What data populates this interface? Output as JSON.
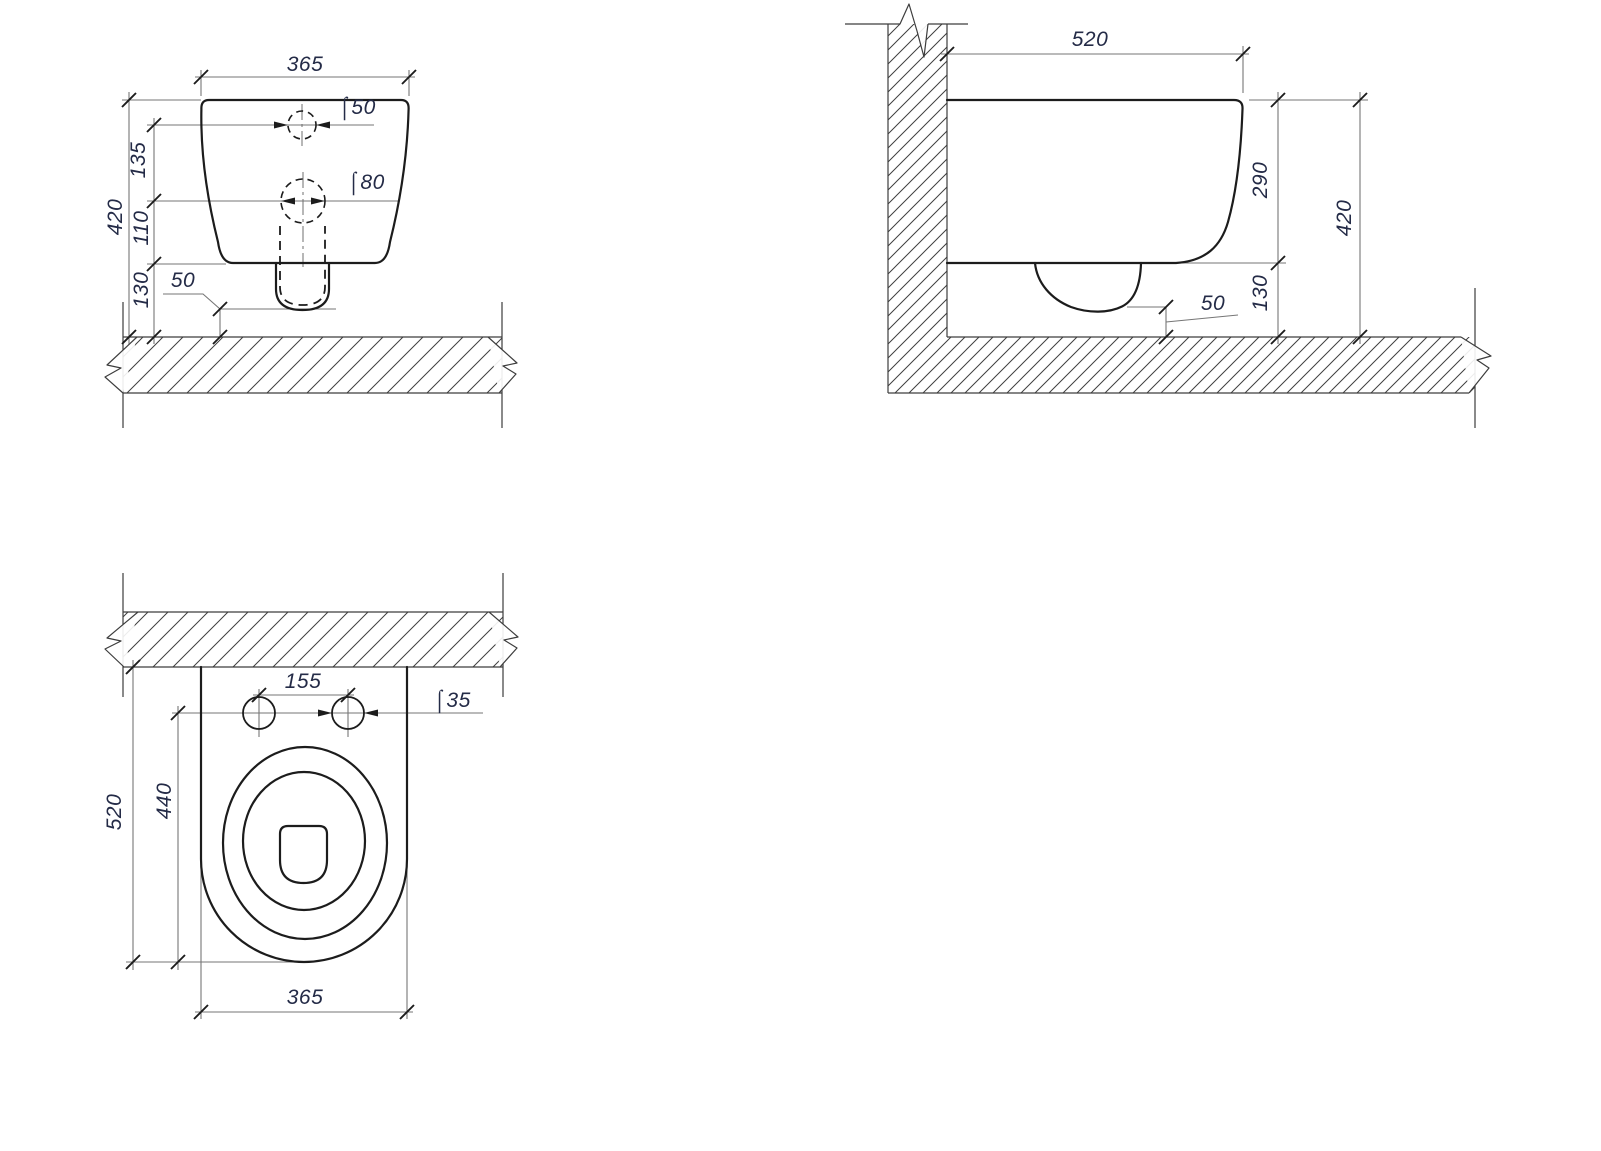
{
  "drawing": {
    "type": "technical-drawing",
    "subject": "wall-hung toilet installation dimensions, three orthographic views",
    "units": "mm",
    "front_view": {
      "width": "365",
      "top_hole_dia": "⌠50",
      "outlet_hole_dia": "⌠80",
      "top_hole_to_outlet_hole": "135",
      "overall_height": "420",
      "outlet_center_to_bottom": "110",
      "bottom_to_floor": "130",
      "outlet_clearance": "50"
    },
    "side_view": {
      "depth": "520",
      "body_height": "290",
      "overall_height": "420",
      "bottom_to_floor": "130",
      "trap_clearance": "50"
    },
    "plan_view": {
      "bolt_spacing": "155",
      "bolt_hole_dia": "⌠35",
      "depth": "520",
      "bolt_line_to_front": "440",
      "width": "365"
    }
  }
}
